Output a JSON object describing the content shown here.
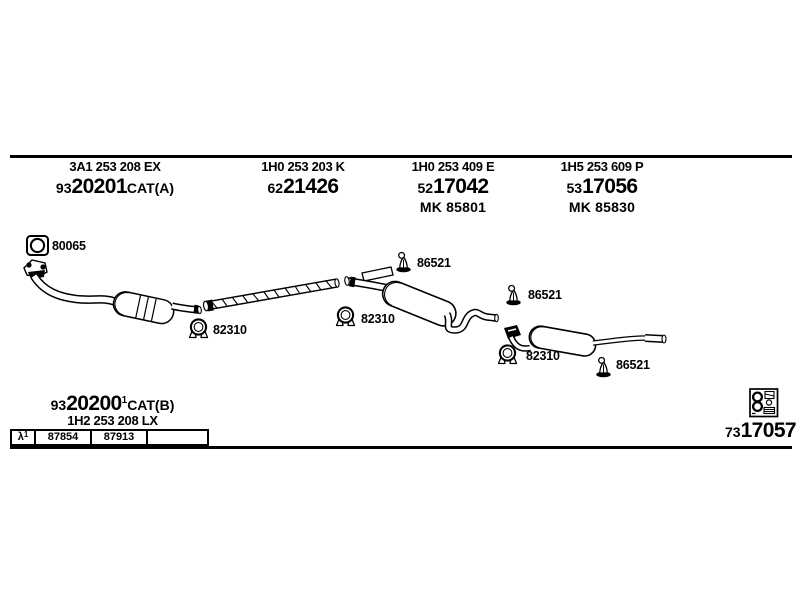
{
  "colors": {
    "ink": "#000000",
    "background": "#ffffff"
  },
  "icons": {
    "flange_gasket": "square-gasket-with-ring",
    "pipe_clamp": "u-bolt-clamp",
    "rubber_hanger": "exhaust-rubber-hanger",
    "fitting_kit": "fitting-kit-assortment-box"
  },
  "header": {
    "groups": [
      {
        "oem_number": "3A1 253 208 EX",
        "code_prefix": "93",
        "code": "20201",
        "code_suffix": "CAT(A)",
        "kit_number": ""
      },
      {
        "oem_number": "1H0 253 203 K",
        "code_prefix": "62",
        "code": "21426",
        "code_suffix": "",
        "kit_number": ""
      },
      {
        "oem_number": "1H0 253 409 E",
        "code_prefix": "52",
        "code": "17042",
        "code_suffix": "",
        "kit_number": "MK 85801"
      },
      {
        "oem_number": "1H5 253 609 P",
        "code_prefix": "53",
        "code": "17056",
        "code_suffix": "",
        "kit_number": "MK 85830"
      }
    ]
  },
  "diagram": {
    "part_labels": [
      {
        "part": "flange-gasket",
        "text": "80065"
      },
      {
        "part": "clamp-front",
        "text": "82310"
      },
      {
        "part": "clamp-middle",
        "text": "82310"
      },
      {
        "part": "hanger-middle",
        "text": "86521"
      },
      {
        "part": "hanger-rear-top",
        "text": "86521"
      },
      {
        "part": "clamp-rear",
        "text": "82310"
      },
      {
        "part": "hanger-rear",
        "text": "86521"
      }
    ]
  },
  "footer": {
    "left_group": {
      "code_prefix": "93",
      "code": "20200",
      "footnote_ref": "1",
      "code_suffix": "CAT(B)",
      "oem_number": "1H2 253 208 LX"
    },
    "fitment_table": {
      "row_header_symbol": "λ",
      "row_header_sup": "1",
      "cells": [
        "87854",
        "87913",
        ""
      ]
    },
    "right_group": {
      "code_prefix": "73",
      "code": "17057"
    }
  }
}
